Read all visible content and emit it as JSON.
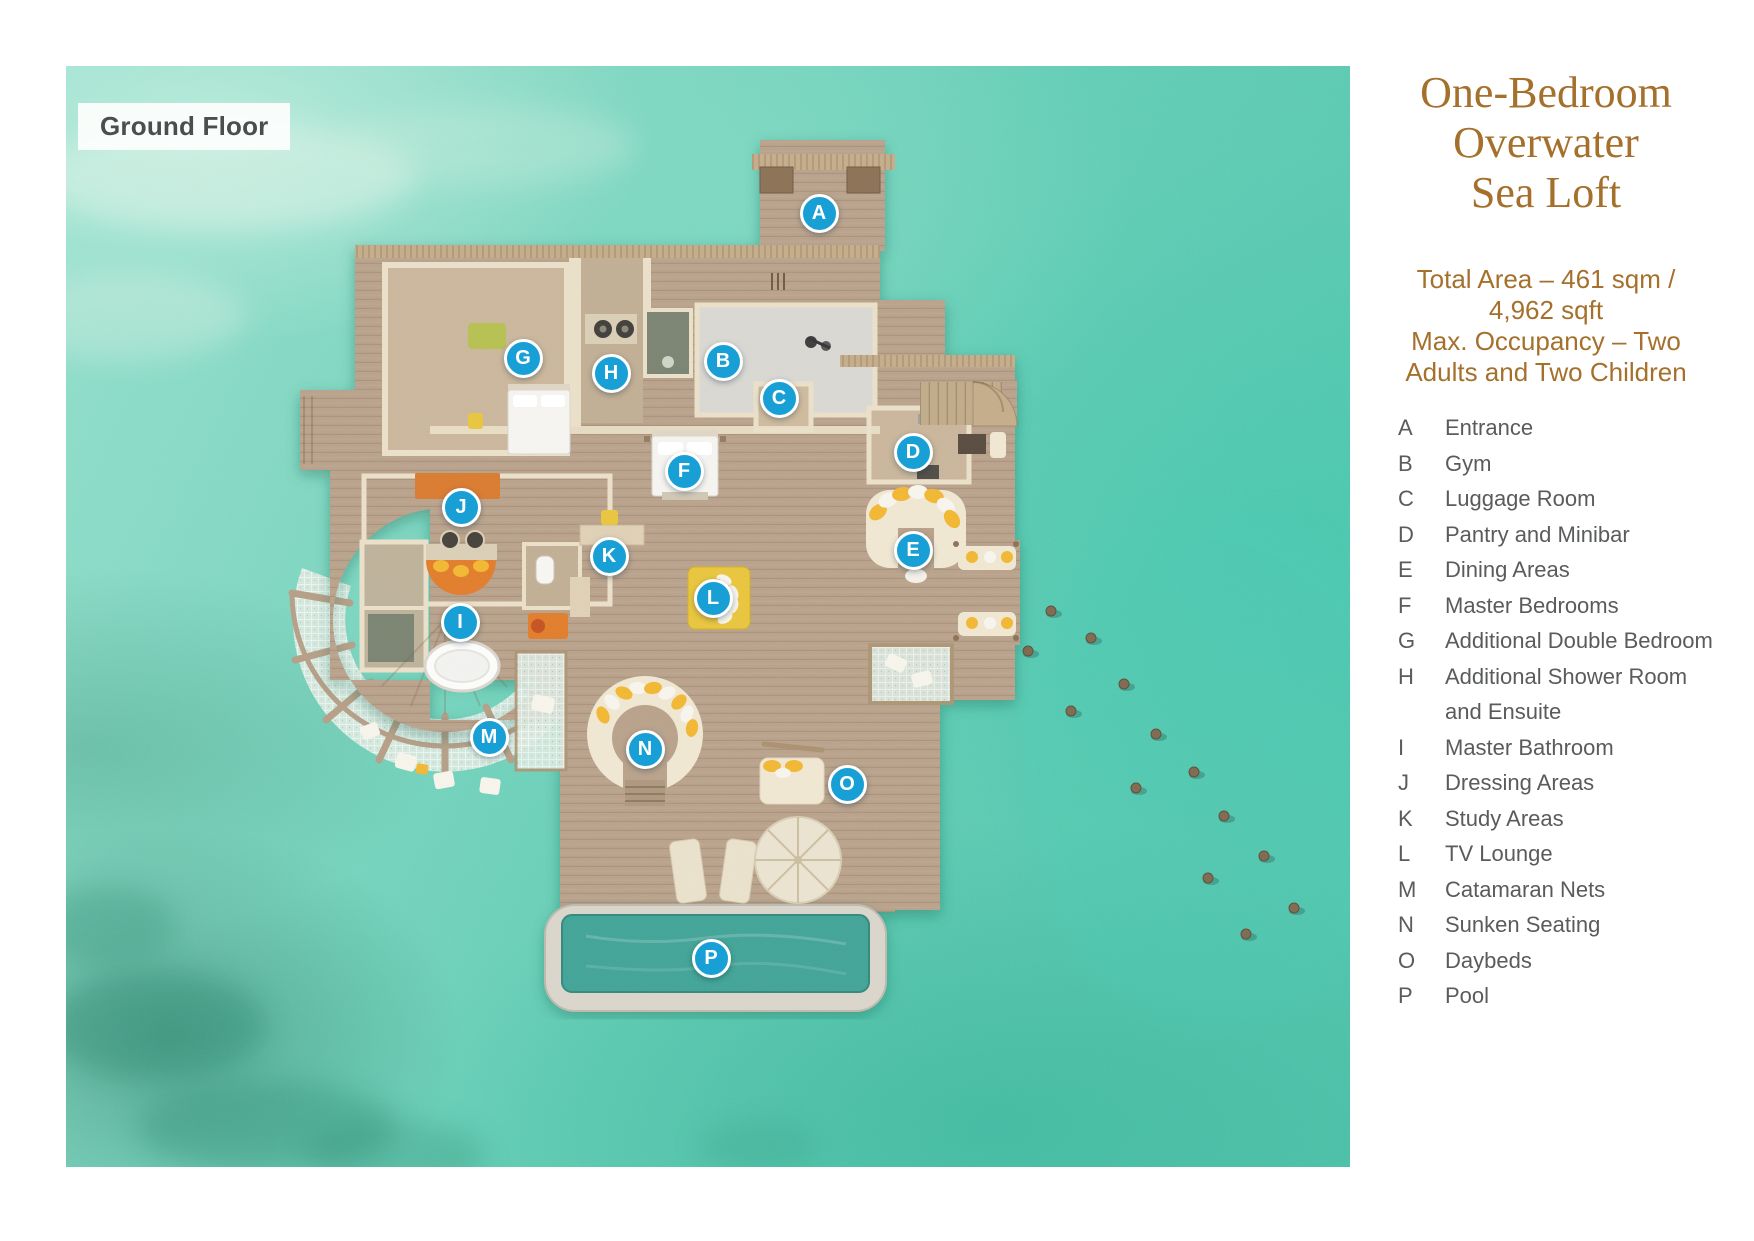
{
  "ground_floor_label": "Ground Floor",
  "panel": {
    "title": "One-Bedroom\nOverwater\nSea Loft",
    "specs": "Total Area – 461 sqm /\n4,962 sqft\nMax. Occupancy – Two\nAdults and Two Children"
  },
  "legend": [
    {
      "letter": "A",
      "label": "Entrance"
    },
    {
      "letter": "B",
      "label": "Gym"
    },
    {
      "letter": "C",
      "label": "Luggage Room"
    },
    {
      "letter": "D",
      "label": "Pantry and Minibar"
    },
    {
      "letter": "E",
      "label": "Dining Areas"
    },
    {
      "letter": "F",
      "label": "Master Bedrooms"
    },
    {
      "letter": "G",
      "label": "Additional Double Bedroom"
    },
    {
      "letter": "H",
      "label": "Additional Shower Room\nand Ensuite"
    },
    {
      "letter": "I",
      "label": "Master Bathroom"
    },
    {
      "letter": "J",
      "label": "Dressing Areas"
    },
    {
      "letter": "K",
      "label": "Study Areas"
    },
    {
      "letter": "L",
      "label": "TV Lounge"
    },
    {
      "letter": "M",
      "label": "Catamaran Nets"
    },
    {
      "letter": "N",
      "label": "Sunken Seating"
    },
    {
      "letter": "O",
      "label": "Daybeds"
    },
    {
      "letter": "P",
      "label": "Pool"
    }
  ],
  "colors": {
    "marker_blue": "#18a0d6",
    "title_brown": "#a5702c",
    "legend_gray": "#595b5d",
    "water_teal": "#5fccb4",
    "deck_wood": "#b7a089",
    "pool_water": "#3fa295"
  }
}
